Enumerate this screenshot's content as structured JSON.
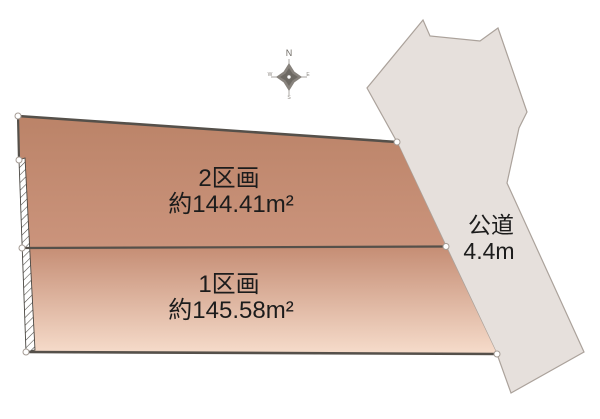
{
  "map": {
    "plot_2": {
      "name": "2区画",
      "area": "約144.41m²"
    },
    "plot_1": {
      "name": "1区画",
      "area": "約145.58m²"
    },
    "road": {
      "label": "公道",
      "width": "4.4m"
    },
    "compass": {
      "north": "N",
      "east": "E",
      "south": "S",
      "west": "W"
    }
  },
  "colors": {
    "plot2_top": "#bb8368",
    "plot2_bottom": "#cb947c",
    "plot1_top": "#c58d74",
    "plot1_bottom": "#f6dccb",
    "road_fill": "#e6e0dc",
    "road_stroke": "#aba29b",
    "boundary": "#55504a",
    "compass": "#87827c",
    "background": "#ffffff"
  }
}
